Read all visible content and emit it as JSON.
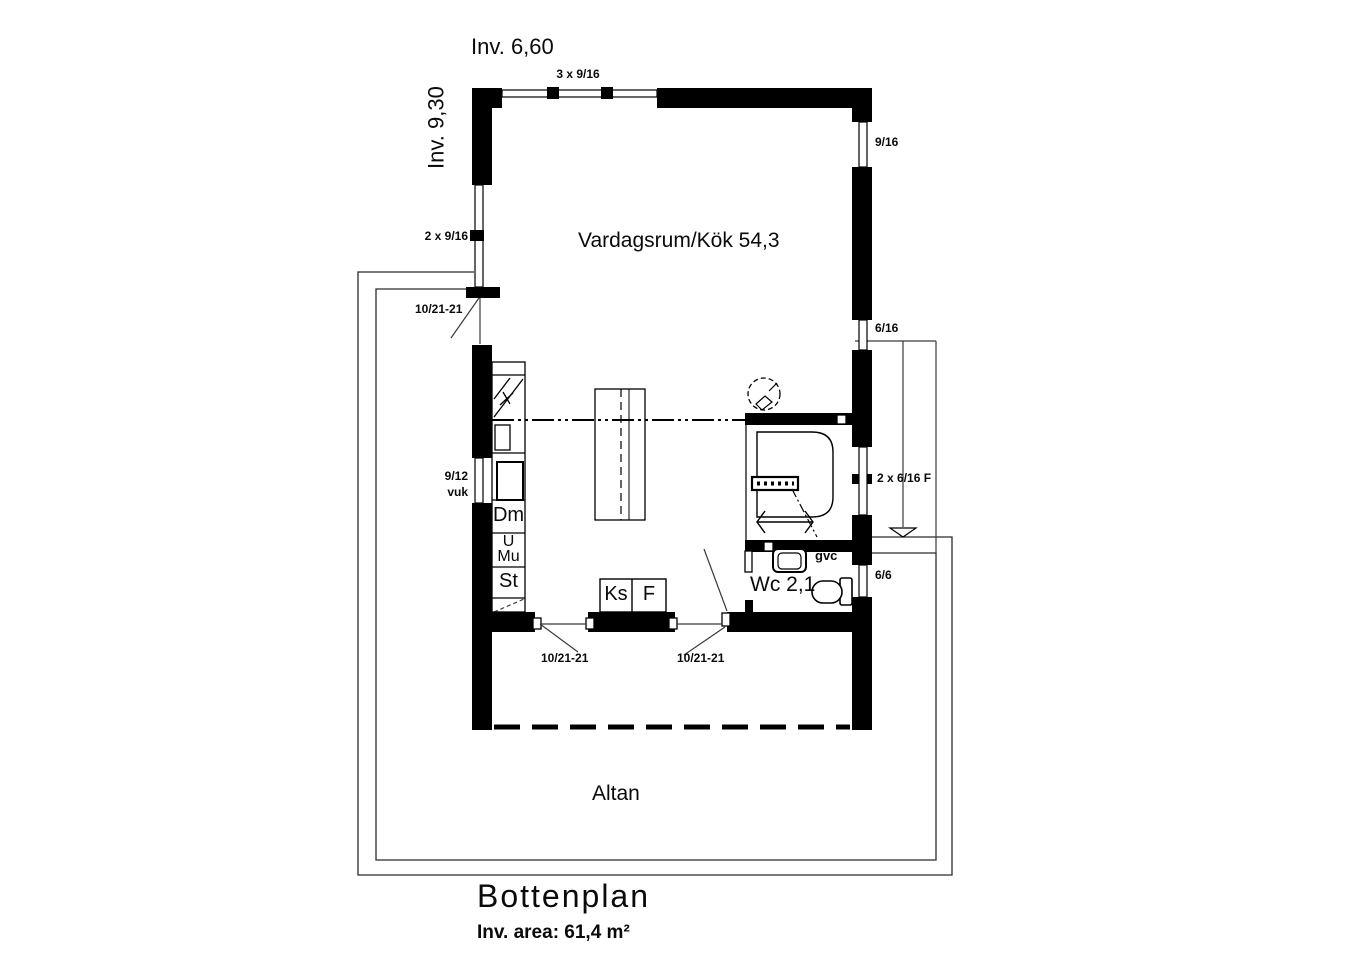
{
  "canvas": {
    "width": 1363,
    "height": 960,
    "ink": "#000000",
    "background": "#ffffff"
  },
  "header": {
    "width_dim": "Inv. 6,60",
    "height_dim": "Inv. 9,30"
  },
  "rooms": {
    "living_kitchen": "Vardagsrum/Kök 54,3",
    "wc": "Wc 2,1",
    "terrace": "Altan"
  },
  "windows": {
    "top_triple": "3 x 9/16",
    "left_double": "2 x 9/16",
    "kitchen_line1": "9/12",
    "kitchen_line2": "vuk",
    "right_upper": "9/16",
    "right_middle": "6/16",
    "wc_double": "2 x 6/16 F",
    "wc_small": "6/6"
  },
  "doors": {
    "entry_left": "10/21-21",
    "terrace_left": "10/21-21",
    "terrace_right": "10/21-21"
  },
  "fixtures": {
    "dishwasher": "Dm",
    "oven": "U",
    "microwave": "Mu",
    "tall_cabinet": "St",
    "fridge": "Ks",
    "freezer": "F",
    "floor_heating": "gvc"
  },
  "footer": {
    "title": "Bottenplan",
    "area": "Inv. area: 61,4 m²"
  }
}
